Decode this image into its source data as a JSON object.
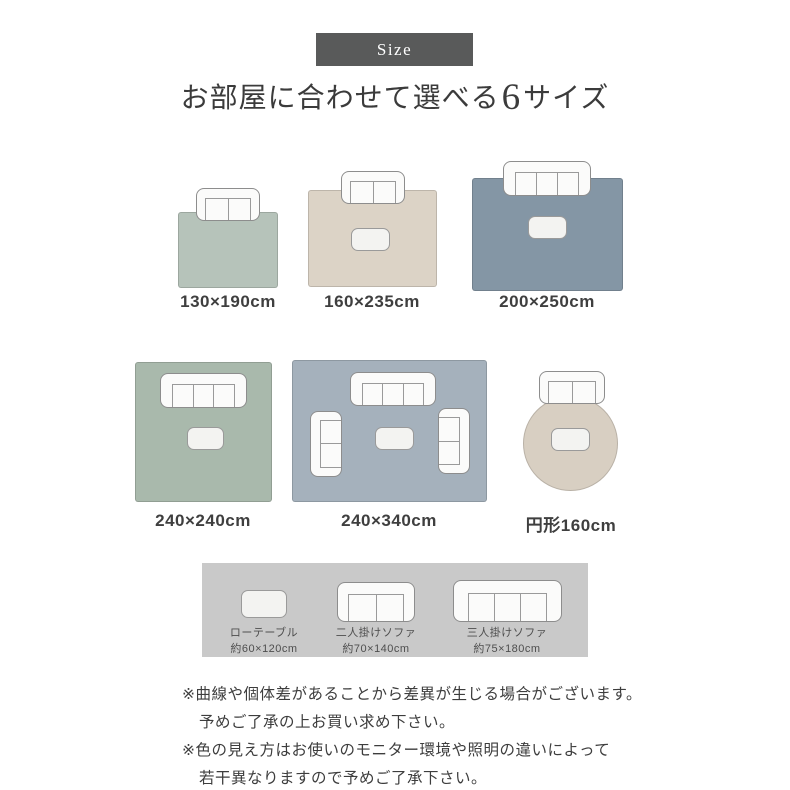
{
  "badge": {
    "label": "Size",
    "background": "#595a5a"
  },
  "title": {
    "prefix": "お部屋に合わせて選べる",
    "count": "6",
    "suffix": "サイズ"
  },
  "rugs": [
    {
      "label": "130×190cm",
      "color": "#b6c3ba",
      "shape": "rect",
      "furniture": [
        "two-seater-sofa"
      ]
    },
    {
      "label": "160×235cm",
      "color": "#dcd3c6",
      "shape": "rect",
      "furniture": [
        "two-seater-sofa",
        "low-table"
      ]
    },
    {
      "label": "200×250cm",
      "color": "#8496a5",
      "shape": "rect",
      "furniture": [
        "three-seater-sofa",
        "low-table"
      ]
    },
    {
      "label": "240×240cm",
      "color": "#a9b9ac",
      "shape": "rect",
      "furniture": [
        "three-seater-sofa",
        "low-table"
      ]
    },
    {
      "label": "240×340cm",
      "color": "#a5b1bc",
      "shape": "rect",
      "furniture": [
        "three-seater-sofa",
        "two-seater-sofa",
        "two-seater-sofa",
        "low-table"
      ]
    },
    {
      "label": "円形160cm",
      "color": "#d8cfc2",
      "shape": "circle",
      "furniture": [
        "two-seater-sofa",
        "low-table"
      ]
    }
  ],
  "legend": {
    "background": "#c9c9c9",
    "items": [
      {
        "name": "ローテーブル",
        "size": "約60×120cm",
        "icon": "low-table-icon"
      },
      {
        "name": "二人掛けソファ",
        "size": "約70×140cm",
        "icon": "two-seater-sofa-icon"
      },
      {
        "name": "三人掛けソファ",
        "size": "約75×180cm",
        "icon": "three-seater-sofa-icon"
      }
    ]
  },
  "notes": [
    {
      "line1": "※曲線や個体差があることから差異が生じる場合がございます。",
      "line2": "予めご了承の上お買い求め下さい。"
    },
    {
      "line1": "※色の見え方はお使いのモニター環境や照明の違いによって",
      "line2": "若干異なりますので予めご了承下さい。"
    }
  ]
}
